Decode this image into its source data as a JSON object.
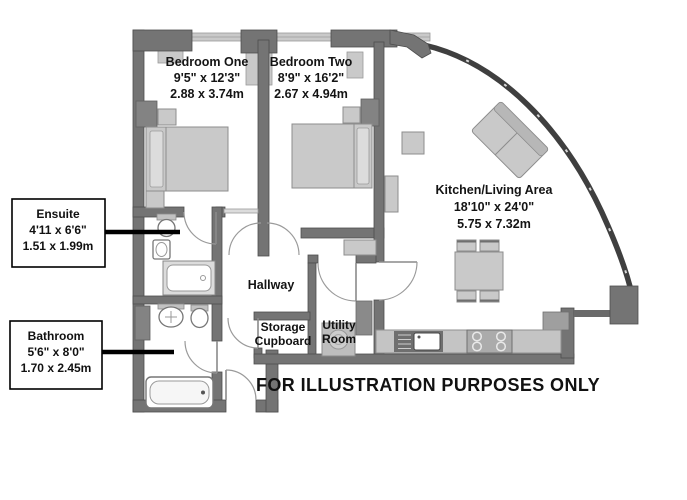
{
  "plan": {
    "rooms": {
      "bedroom_one": {
        "name": "Bedroom One",
        "imperial": "9'5\" x 12'3\"",
        "metric": "2.88 x 3.74m"
      },
      "bedroom_two": {
        "name": "Bedroom Two",
        "imperial": "8'9\" x 16'2\"",
        "metric": "2.67 x 4.94m"
      },
      "kitchen_living": {
        "name": "Kitchen/Living Area",
        "imperial": "18'10\" x 24'0\"",
        "metric": "5.75 x 7.32m"
      },
      "hallway": {
        "name": "Hallway"
      },
      "storage_cupboard": {
        "name_line1": "Storage",
        "name_line2": "Cupboard"
      },
      "utility_room": {
        "name_line1": "Utility",
        "name_line2": "Room"
      }
    },
    "callouts": {
      "ensuite": {
        "name": "Ensuite",
        "imperial": "4'11 x 6'6\"",
        "metric": "1.51 x 1.99m"
      },
      "bathroom": {
        "name": "Bathroom",
        "imperial": "5'6\" x 8'0\"",
        "metric": "1.70 x 2.45m"
      }
    },
    "disclaimer": "FOR ILLUSTRATION PURPOSES ONLY",
    "colors": {
      "wall": "#747474",
      "wall_edge": "#4e4e4e",
      "furniture": "#c9c9c9",
      "glass_wall": "#3f3f3f",
      "leader_line": "#000000",
      "background": "#ffffff"
    }
  }
}
